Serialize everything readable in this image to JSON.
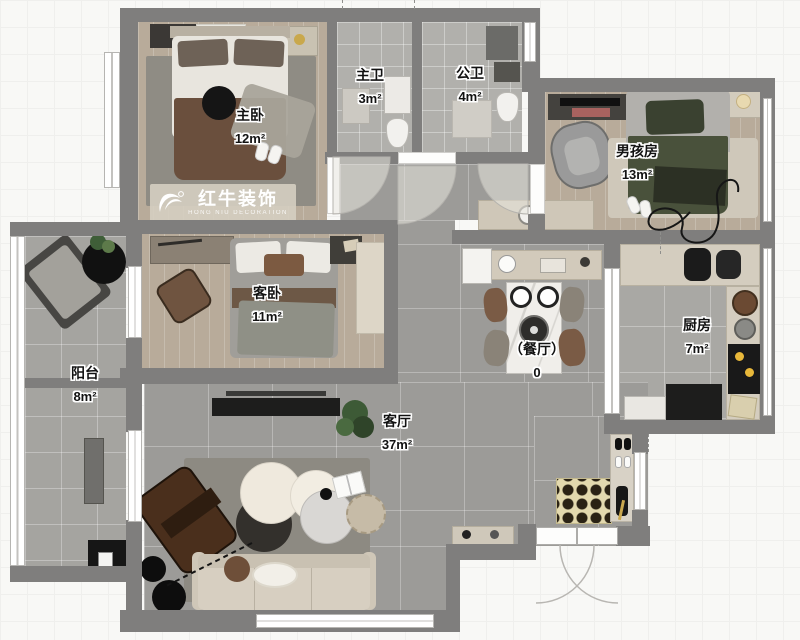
{
  "plan": {
    "watermark": {
      "brand": "红牛装饰",
      "subtitle": "HONG NIU DECORATION"
    },
    "rooms": {
      "master_bedroom": {
        "name": "主卧",
        "area": "12m²"
      },
      "master_bath": {
        "name": "主卫",
        "area": "3m²"
      },
      "public_bath": {
        "name": "公卫",
        "area": "4m²"
      },
      "boys_room": {
        "name": "男孩房",
        "area": "13m²"
      },
      "guest_bedroom": {
        "name": "客卧",
        "area": "11m²"
      },
      "balcony": {
        "name": "阳台",
        "area": "8m²"
      },
      "dining": {
        "name": "（餐厅）",
        "area": "0"
      },
      "kitchen": {
        "name": "厨房",
        "area": "7m²"
      },
      "living_room": {
        "name": "客厅",
        "area": "37m²"
      }
    },
    "palette": {
      "wall": "#7f7e7d",
      "wood_floor": "#b8ab9a",
      "tile_floor": "#9c9b98",
      "bath_tile": "#b1b0ac",
      "balcony_tile": "#a5a4a0",
      "kitchen_tile": "#a9a8a4",
      "watermark_bg": "#d5cec1",
      "sofa_beige": "#d7cfc1",
      "bed_blanket_brown": "#6a4f3d",
      "boys_blanket_green": "#49513b",
      "doormat": "#e3d9ae"
    }
  }
}
